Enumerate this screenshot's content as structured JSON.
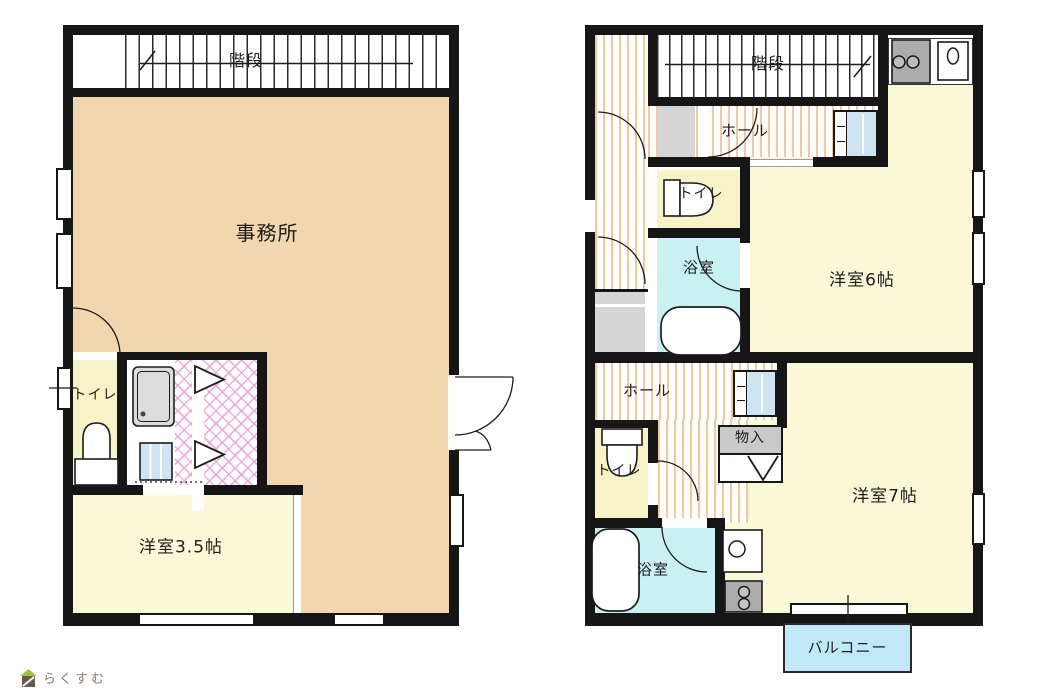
{
  "branding": {
    "logo_text": "らくすむ"
  },
  "left_plan": {
    "rooms": {
      "stairs": "階段",
      "office": "事務所",
      "toilet": "トイレ",
      "western_room": "洋室3.5帖"
    }
  },
  "right_plan": {
    "rooms": {
      "stairs": "階段",
      "hall_upper": "ホール",
      "toilet_upper": "トイレ",
      "bath_upper": "浴室",
      "western_room_6": "洋室6帖",
      "hall_lower": "ホール",
      "storage": "物入",
      "toilet_lower": "トイレ",
      "bath_lower": "浴室",
      "western_room_7": "洋室7帖",
      "balcony": "バルコニー"
    }
  },
  "colors": {
    "wall": "#161616",
    "office_floor": "#f2d6ae",
    "room_floor": "#fbf8d8",
    "toilet_floor": "#f7f3c6",
    "bath_floor": "#c9f1f2",
    "balcony_floor": "#bfe9f6",
    "hall_stripe": "#f2c89e",
    "lattice_pink": "#eea0d7",
    "cabinet_blue": "#cfe4f2",
    "fixture_gray": "#acacac",
    "landing_gray": "#d5d5d5",
    "logo_text_color": "#8a796c"
  }
}
